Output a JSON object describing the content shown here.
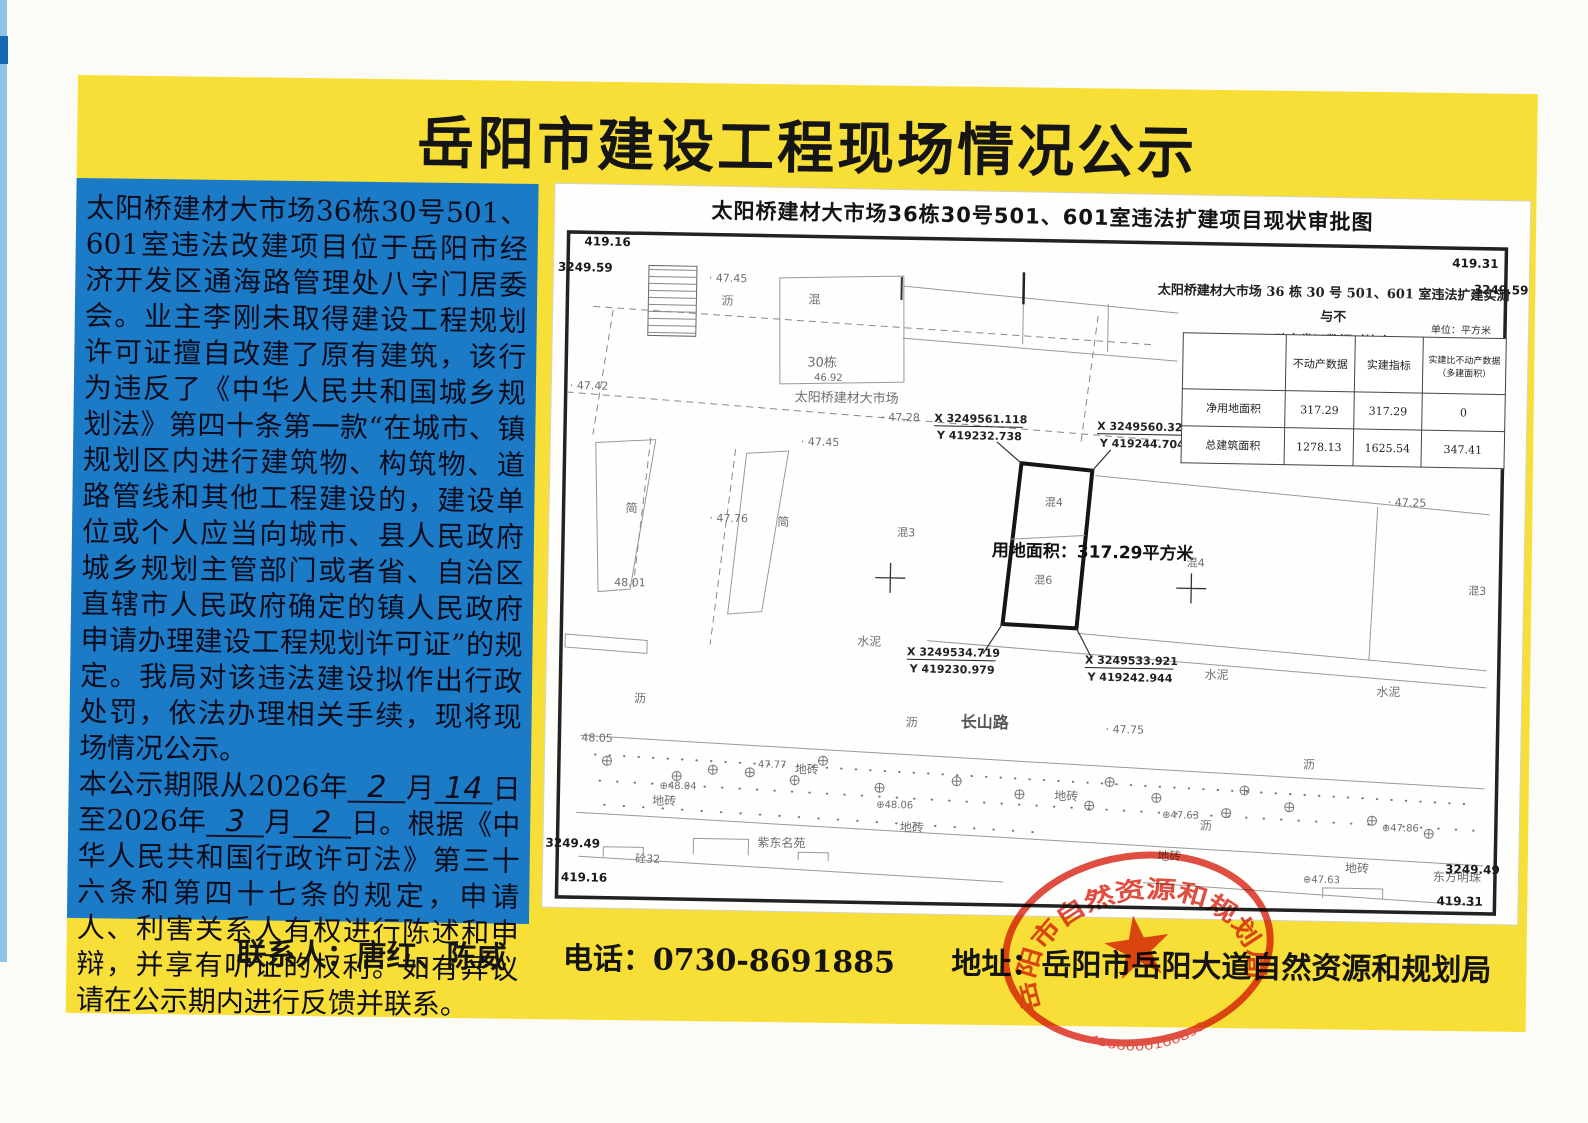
{
  "title": "岳阳市建设工程现场情况公示",
  "notice": {
    "p1": "太阳桥建材大市场36栋30号501、601室违法改建项目位于岳阳市经济开发区通海路管理处八字门居委会。业主李刚未取得建设工程规划许可证擅自改建了原有建筑，该行为违反了《中华人民共和国城乡规划法》第四十条第一款“在城市、镇规划区内进行建筑物、构筑物、道路管线和其他工程建设的，建设单位或个人应当向城市、县人民政府城乡规划主管部门或者省、自治区直辖市人民政府确定的镇人民政府申请办理建设工程规划许可证”的规定。我局对该违法建设拟作出行政处罚，依法办理相关手续，现将现场情况公示。",
    "p2": {
      "a": "本公示期限从2026年",
      "m1": "2",
      "b": "月",
      "d1": "14",
      "c": "日至2026年",
      "m2": "3",
      "d": "月",
      "d2": "2",
      "e": "日。根据《中华人民共和国行政许可法》第三十六条和第四十七条的规定，申请人、利害关系人有权进行陈述和申辩，并享有听证的权利。如有异议请在公示期内进行反馈并联系。"
    }
  },
  "map": {
    "sheet_title": "太阳桥建材大市场36栋30号501、601室违法扩建项目现状审批图",
    "corners": {
      "tl_y": "419.16",
      "tl_x": "3249.59",
      "tr_y": "419.31",
      "tr_x": "3249.59",
      "bl_x": "3249.49",
      "bl_y": "419.16",
      "br_x": "3249.49",
      "br_y": "419.31"
    },
    "table": {
      "title1": "太阳桥建材大市场 36 栋 30 号 501、601 室违法扩建实测与不",
      "title2": "动产发证数据对比表",
      "unit": "单位：平方米",
      "headers": [
        "",
        "不动产数据",
        "实建指标",
        "实建比不动产数据（多建面积）"
      ],
      "rows": [
        [
          "净用地面积",
          "317.29",
          "317.29",
          "0"
        ],
        [
          "总建筑面积",
          "1278.13",
          "1625.54",
          "347.41"
        ]
      ]
    },
    "area_label": "用地面积：317.29平方米",
    "labels": [
      {
        "t": "沥",
        "x": 168,
        "y": 118,
        "s": 12
      },
      {
        "t": "混",
        "x": 255,
        "y": 115,
        "s": 12
      },
      {
        "t": "30栋",
        "x": 255,
        "y": 178,
        "s": 13
      },
      {
        "t": "46.92",
        "x": 262,
        "y": 192,
        "s": 10
      },
      {
        "t": "太阳桥建材大市场",
        "x": 243,
        "y": 213,
        "s": 13
      },
      {
        "t": "· 47.45",
        "x": 155,
        "y": 95,
        "s": 11
      },
      {
        "t": "· 47.42",
        "x": 18,
        "y": 205,
        "s": 11
      },
      {
        "t": "· 47.28",
        "x": 330,
        "y": 231,
        "s": 11
      },
      {
        "t": "· 47.45",
        "x": 250,
        "y": 257,
        "s": 11
      },
      {
        "t": "· 47.76",
        "x": 160,
        "y": 335,
        "s": 11
      },
      {
        "t": "48.01",
        "x": 66,
        "y": 401,
        "s": 11
      },
      {
        "t": "简",
        "x": 76,
        "y": 327,
        "s": 12
      },
      {
        "t": "简",
        "x": 228,
        "y": 338,
        "s": 12
      },
      {
        "t": "混3",
        "x": 348,
        "y": 346,
        "s": 11
      },
      {
        "t": "混4",
        "x": 495,
        "y": 313,
        "s": 11
      },
      {
        "t": "混6",
        "x": 486,
        "y": 391,
        "s": 11
      },
      {
        "t": "用地面积：317.29平方米",
        "x": 443,
        "y": 364,
        "s": 17,
        "b": 1,
        "c": "#111"
      },
      {
        "t": "混4",
        "x": 638,
        "y": 371,
        "s": 11
      },
      {
        "t": "· 47.25",
        "x": 838,
        "y": 307,
        "s": 11
      },
      {
        "t": "混3",
        "x": 920,
        "y": 394,
        "s": 11
      },
      {
        "t": "水泥",
        "x": 310,
        "y": 456,
        "s": 12
      },
      {
        "t": "水泥",
        "x": 658,
        "y": 483,
        "s": 12
      },
      {
        "t": "水泥",
        "x": 830,
        "y": 497,
        "s": 12
      },
      {
        "t": "沥",
        "x": 88,
        "y": 517,
        "s": 12
      },
      {
        "t": "沥",
        "x": 360,
        "y": 536,
        "s": 12
      },
      {
        "t": "长山路",
        "x": 415,
        "y": 536,
        "s": 16,
        "b": 1,
        "c": "#555"
      },
      {
        "t": "· 47.75",
        "x": 560,
        "y": 539,
        "s": 11
      },
      {
        "t": "48.05",
        "x": 36,
        "y": 557,
        "s": 11
      },
      {
        "t": "47.77",
        "x": 213,
        "y": 580,
        "s": 10
      },
      {
        "t": "⊕48.04",
        "x": 115,
        "y": 603,
        "s": 10
      },
      {
        "t": "地砖",
        "x": 250,
        "y": 585,
        "s": 12
      },
      {
        "t": "地砖",
        "x": 108,
        "y": 619,
        "s": 12
      },
      {
        "t": "⊕48.06",
        "x": 332,
        "y": 618,
        "s": 10
      },
      {
        "t": "地砖",
        "x": 356,
        "y": 641,
        "s": 12
      },
      {
        "t": "地砖",
        "x": 510,
        "y": 607,
        "s": 12
      },
      {
        "t": "⊕47.63",
        "x": 618,
        "y": 623,
        "s": 10
      },
      {
        "t": "沥",
        "x": 758,
        "y": 571,
        "s": 12
      },
      {
        "t": "⊕47.86",
        "x": 838,
        "y": 632,
        "s": 10
      },
      {
        "t": "地砖",
        "x": 614,
        "y": 665,
        "s": 12
      },
      {
        "t": "沥",
        "x": 656,
        "y": 634,
        "s": 12
      },
      {
        "t": "地砖",
        "x": 802,
        "y": 674,
        "s": 12
      },
      {
        "t": "⊕47.63",
        "x": 760,
        "y": 685,
        "s": 10
      },
      {
        "t": "紫东名苑",
        "x": 214,
        "y": 659,
        "s": 12
      },
      {
        "t": "砼32",
        "x": 92,
        "y": 677,
        "s": 11
      },
      {
        "t": "东方明珠",
        "x": 890,
        "y": 681,
        "s": 12
      },
      {
        "t": "X 3249561.118",
        "x": 383,
        "y": 231,
        "s": 11,
        "b": 1,
        "c": "#222",
        "u": 1
      },
      {
        "t": "Y 419232.738",
        "x": 386,
        "y": 248,
        "s": 11,
        "b": 1,
        "c": "#222"
      },
      {
        "t": "X 3249560.321",
        "x": 546,
        "y": 236,
        "s": 11,
        "b": 1,
        "c": "#222",
        "u": 1
      },
      {
        "t": "Y 419244.704",
        "x": 549,
        "y": 253,
        "s": 11,
        "b": 1,
        "c": "#222"
      },
      {
        "t": "X 3249534.719",
        "x": 360,
        "y": 465,
        "s": 11,
        "b": 1,
        "c": "#222",
        "u": 1
      },
      {
        "t": "Y 419230.979",
        "x": 363,
        "y": 482,
        "s": 11,
        "b": 1,
        "c": "#222"
      },
      {
        "t": "X 3249533.921",
        "x": 538,
        "y": 470,
        "s": 11,
        "b": 1,
        "c": "#222",
        "u": 1
      },
      {
        "t": "Y 419242.944",
        "x": 541,
        "y": 487,
        "s": 11,
        "b": 1,
        "c": "#222"
      }
    ],
    "plus_marks": [
      [
        62,
        576
      ],
      [
        132,
        590
      ],
      [
        205,
        585
      ],
      [
        278,
        572
      ],
      [
        335,
        598
      ],
      [
        412,
        590
      ],
      [
        475,
        602
      ],
      [
        545,
        612
      ],
      [
        612,
        603
      ],
      [
        682,
        617
      ],
      [
        745,
        610
      ],
      [
        828,
        622
      ],
      [
        885,
        634
      ],
      [
        168,
        583
      ],
      [
        250,
        592
      ],
      [
        700,
        594
      ],
      [
        565,
        588
      ]
    ]
  },
  "footer": {
    "contact": "联系人：唐红、陈威",
    "phone": "电话：0730-8691885",
    "address": "地址：岳阳市岳阳大道自然资源和规划局"
  },
  "seal": {
    "org": "岳阳市自然资源和规划局",
    "code": "4306000100893"
  }
}
